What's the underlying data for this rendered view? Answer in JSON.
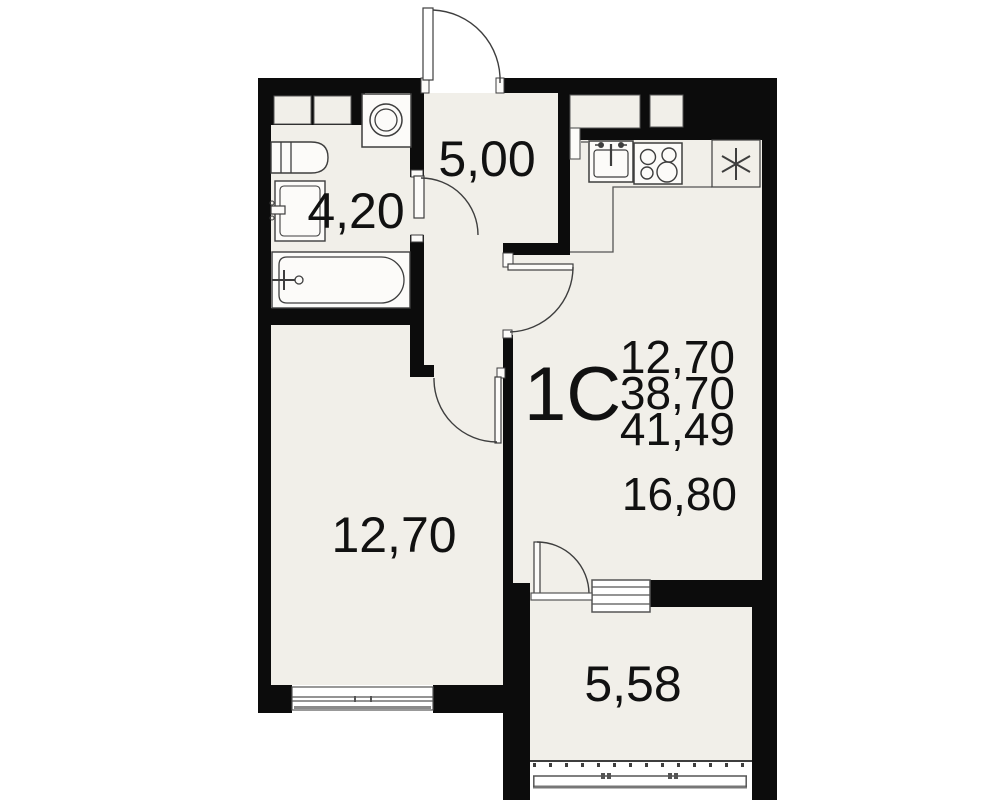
{
  "plan": {
    "apartment_label": "1С",
    "area_stack": {
      "line1": "12,70",
      "line2": "38,70",
      "line3": "41,49"
    },
    "rooms": {
      "bathroom": {
        "area": "4,20"
      },
      "hallway": {
        "area": "5,00"
      },
      "bedroom": {
        "area": "12,70"
      },
      "kitchen_living": {
        "area": "16,80"
      },
      "balcony": {
        "area": "5,58"
      }
    },
    "icons": {
      "washing_machine": "washing-machine-top-view",
      "sink_counter": "bathroom-sink-counter",
      "washbasin": "washbasin-cabinet",
      "bathtub": "bathtub-top-view",
      "kitchen_sink": "kitchen-sink-top-view",
      "stove": "four-burner-stove-top-view",
      "fridge": "fridge-snowflake-asterisk"
    },
    "colors": {
      "wall": "#0c0c0c",
      "floor": "#f1efe9",
      "fixture_fill": "#fcfbf9",
      "line": "#3e3e3e",
      "background": "#ffffff",
      "text": "#111111"
    }
  }
}
